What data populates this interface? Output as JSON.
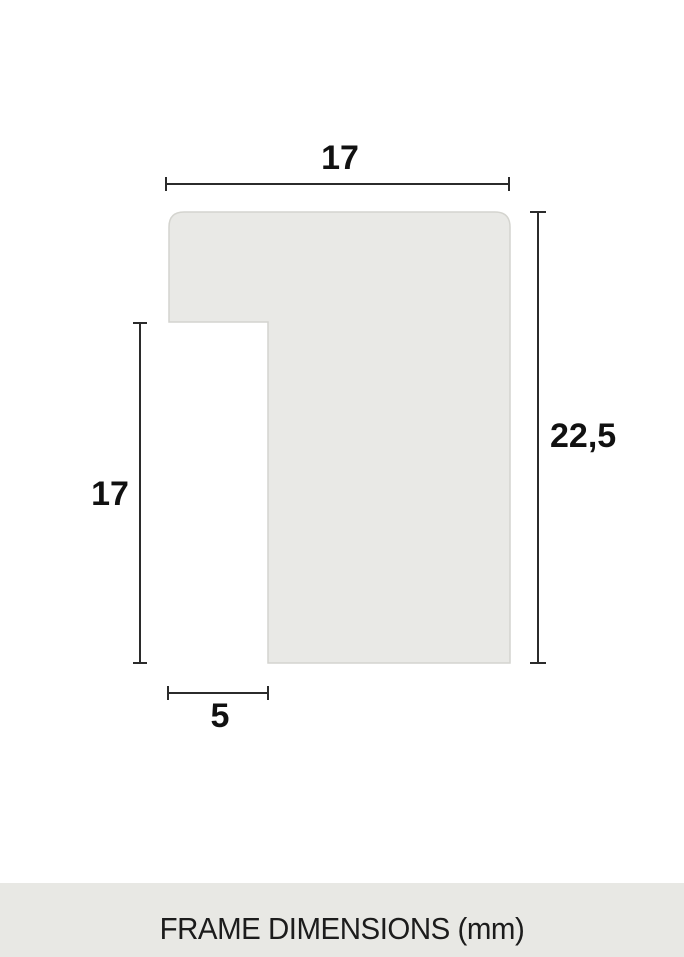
{
  "dimensions": {
    "top_width": "17",
    "right_height": "22,5",
    "left_height": "17",
    "bottom_width": "5"
  },
  "footer": {
    "label": "FRAME DIMENSIONS (mm)"
  },
  "colors": {
    "shape_fill": "#e9e9e6",
    "shape_border": "#d4d4cf",
    "dimension_line": "#2b2b2b",
    "label_text": "#111111",
    "footer_background": "#e8e8e4",
    "footer_text": "#1c1c1c",
    "page_background": "#ffffff"
  }
}
